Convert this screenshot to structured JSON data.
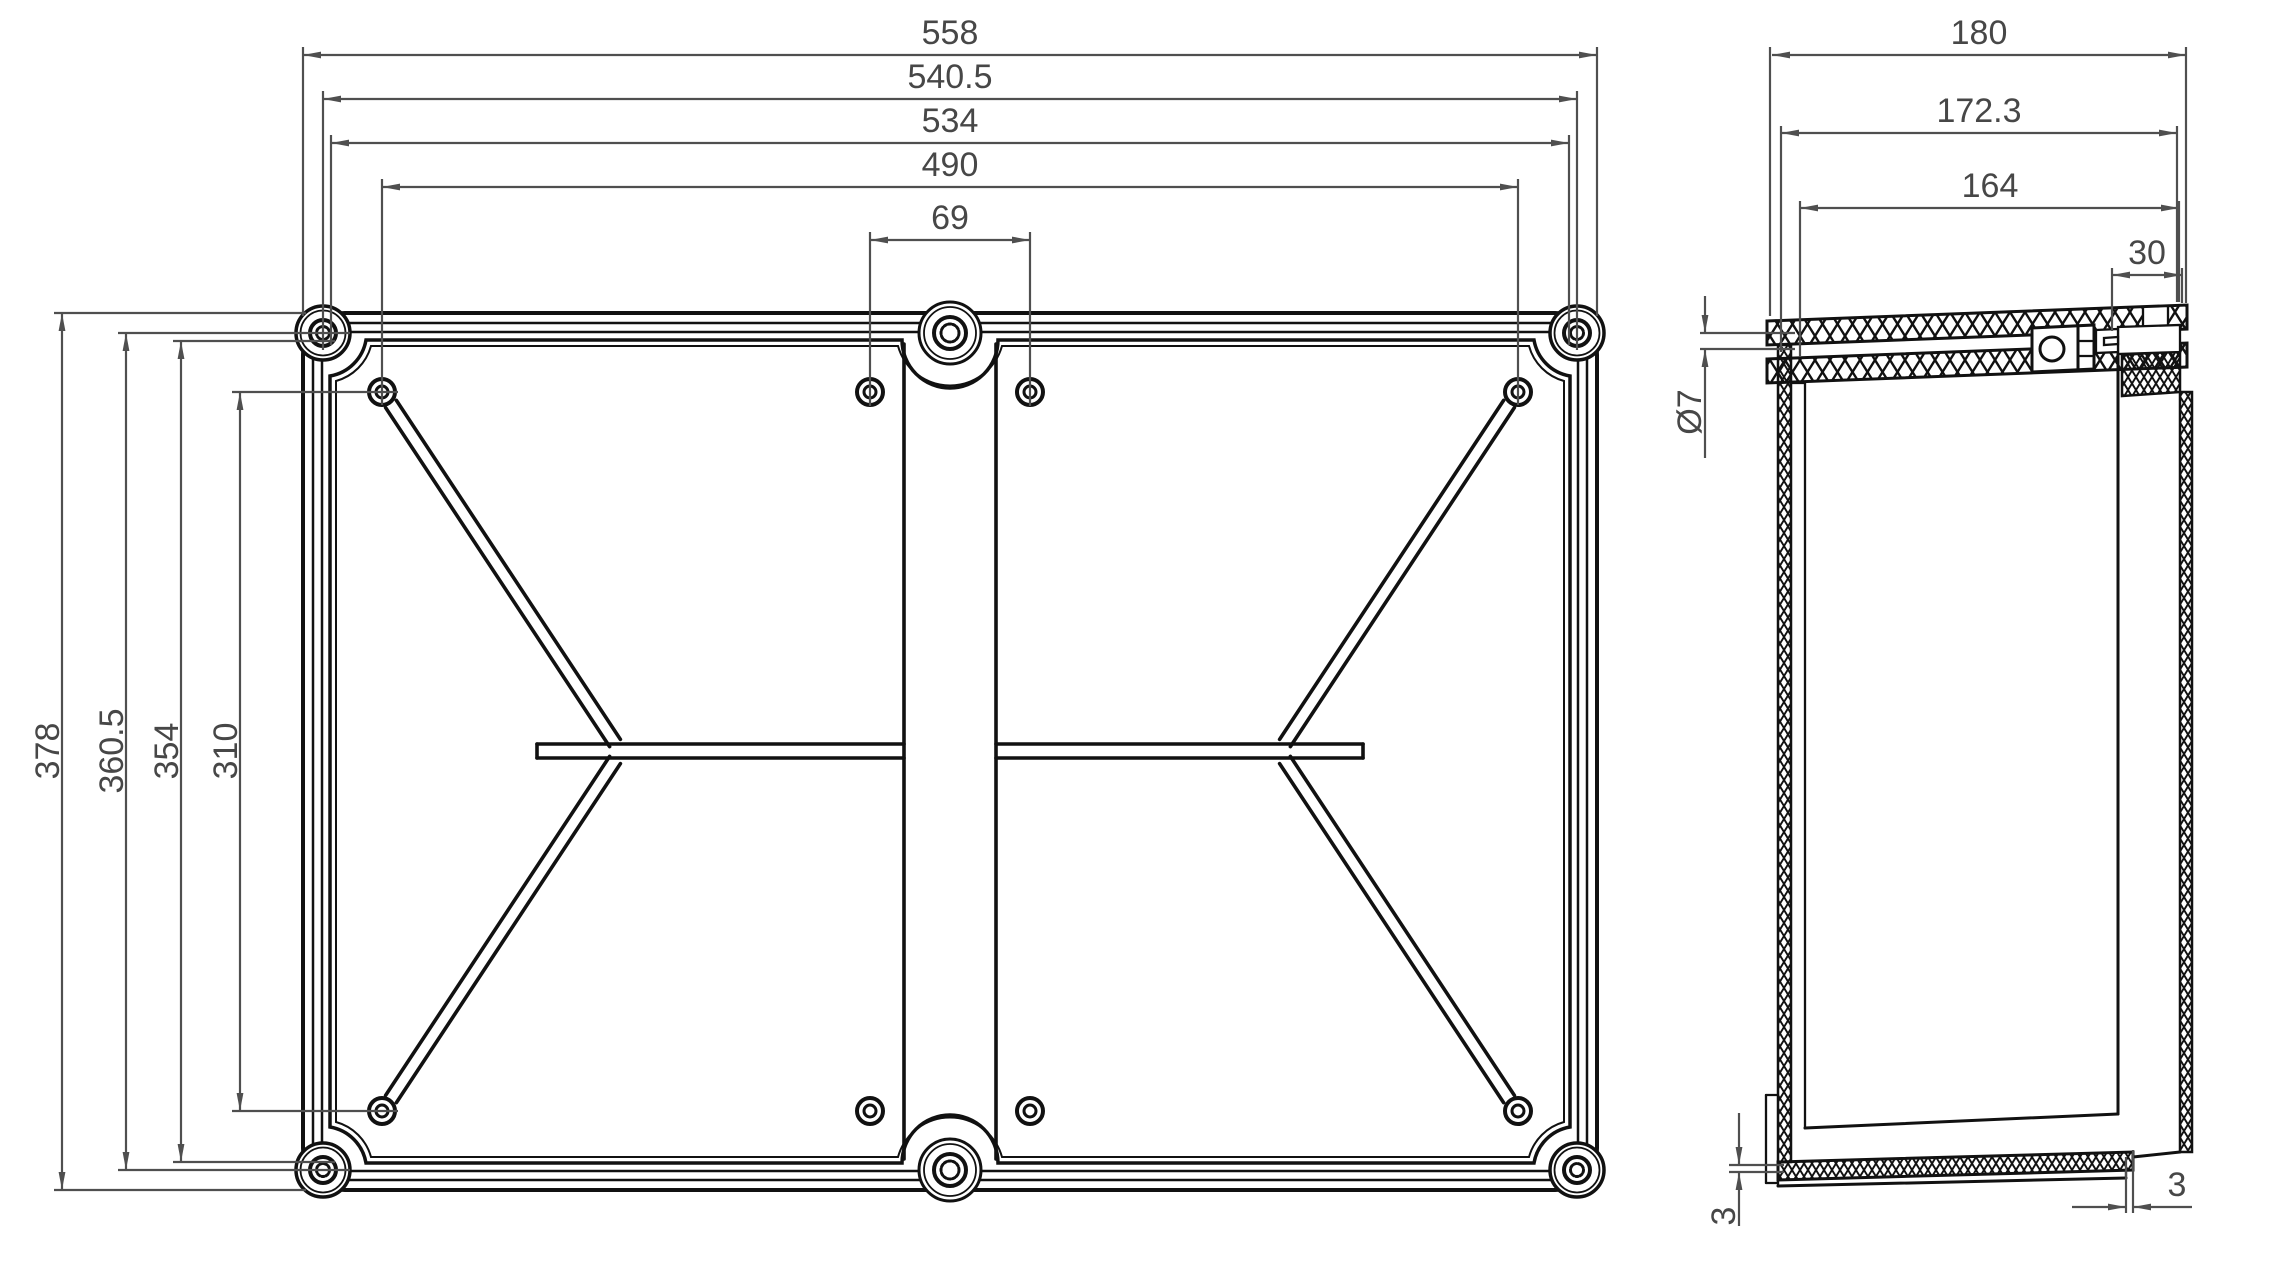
{
  "front_view": {
    "h_dims": {
      "outer": "558",
      "screw_centers": "540.5",
      "inner_rim": "534",
      "hole_centers": "490",
      "center_holes": "69"
    },
    "v_dims": {
      "outer": "378",
      "screw_centers": "360.5",
      "inner_rim": "354",
      "hole_centers": "310"
    }
  },
  "side_view": {
    "h_dims": {
      "outer": "180",
      "lid": "172.3",
      "body": "164",
      "lid_depth": "30"
    },
    "hole_diameter": "Ø7",
    "base_lip": "3",
    "wall_offset": "3"
  },
  "colors": {
    "line": "#111111",
    "dimension": "#4f4f4f",
    "text": "#474747",
    "background": "#ffffff"
  }
}
